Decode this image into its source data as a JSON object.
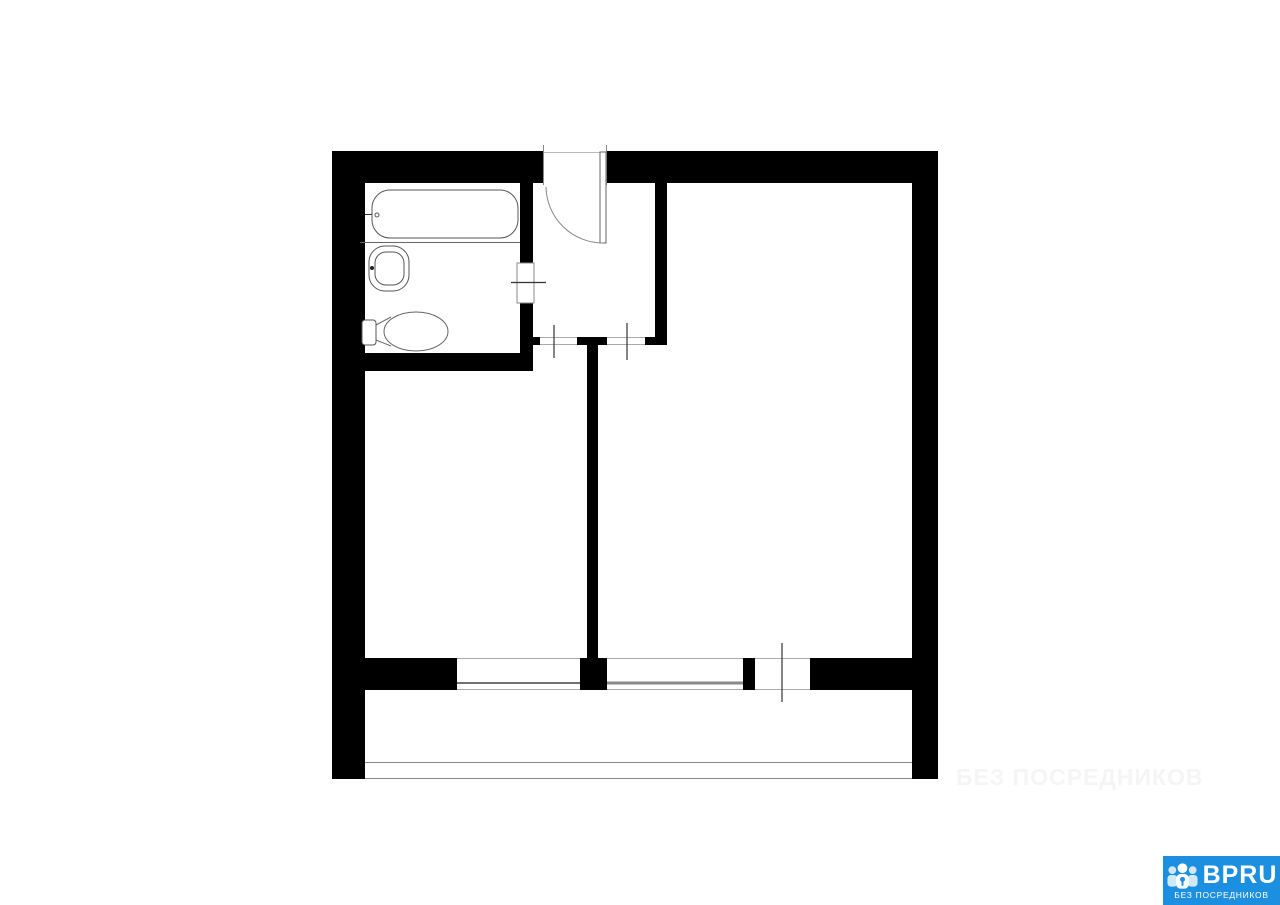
{
  "plan": {
    "background": "#ffffff",
    "wall_color": "#000000",
    "fixture_line_color": "#555555",
    "fixtures": [
      "bathtub",
      "sink",
      "toilet"
    ],
    "doors": [
      "entrance-door",
      "bathroom-door",
      "left-room-door",
      "right-room-door",
      "balcony-door"
    ],
    "windows_count": 2,
    "balcony": true
  },
  "watermark": {
    "text": "БЕЗ ПОСРЕДНИКОВ",
    "color": "#f5f5f5"
  },
  "logo": {
    "brand": "BPRU",
    "tagline": "БЕЗ ПОСРЕДНИКОВ",
    "background": "#1d8fe1",
    "text_color": "#ffffff",
    "icon": "people-group-icon"
  }
}
